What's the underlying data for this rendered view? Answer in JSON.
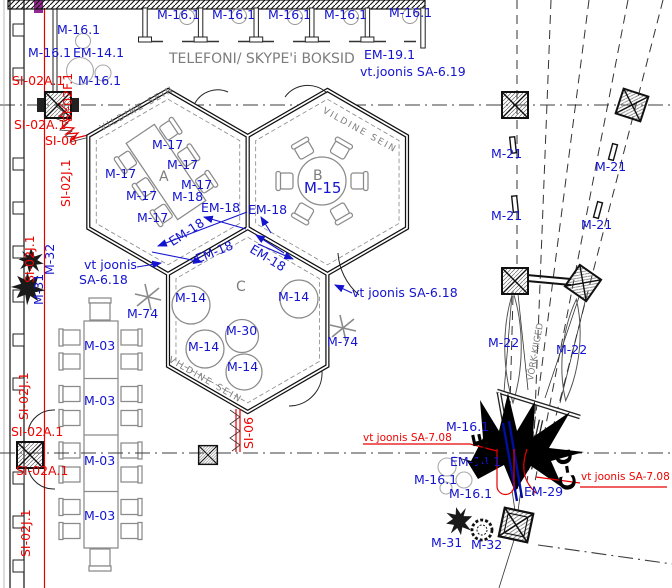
{
  "colors": {
    "label_blue": "#1414cf",
    "reference_red": "#ee0400",
    "annotation_gray": "#7d7d7d",
    "wall_black": "#111111",
    "highlight_magenta": "#92278f",
    "cable_navy": "#000f9e"
  },
  "labels": [
    {
      "t": "M-16.1",
      "x": 57,
      "y": 24
    },
    {
      "t": "M-16.1",
      "x": 28,
      "y": 47
    },
    {
      "t": "EM-14.1",
      "x": 73,
      "y": 47
    },
    {
      "t": "M-16.1",
      "x": 78,
      "y": 75
    },
    {
      "t": "M-16.1",
      "x": 157,
      "y": 9
    },
    {
      "t": "M-16.1",
      "x": 212,
      "y": 9
    },
    {
      "t": "M-16.1",
      "x": 268,
      "y": 9
    },
    {
      "t": "M-16.1",
      "x": 324,
      "y": 9
    },
    {
      "t": "M-16.1",
      "x": 389,
      "y": 7
    },
    {
      "t": "EM-19.1",
      "x": 364,
      "y": 49
    },
    {
      "t": "vt.joonis SA-6.19",
      "x": 360,
      "y": 66
    },
    {
      "t": "TELEFONI/ SKYPE'i BOKSID",
      "x": 169,
      "y": 52,
      "c": "gray",
      "s": 14
    },
    {
      "t": "SI-02F.1",
      "x": 62,
      "y": 122,
      "r": -90,
      "c": "red"
    },
    {
      "t": "SI-02A.1",
      "x": 12,
      "y": 75,
      "c": "red"
    },
    {
      "t": "SI-02A.1",
      "x": 14,
      "y": 119,
      "c": "red"
    },
    {
      "t": "SI-06",
      "x": 45,
      "y": 135,
      "c": "red"
    },
    {
      "t": "SI-02J.1",
      "x": 60,
      "y": 207,
      "r": -90,
      "c": "red"
    },
    {
      "t": "SI-02J.1",
      "x": 24,
      "y": 283,
      "r": -90,
      "c": "red"
    },
    {
      "t": "M-32",
      "x": 44,
      "y": 275,
      "r": -90
    },
    {
      "t": "M-31",
      "x": 33,
      "y": 305,
      "r": -90
    },
    {
      "t": "vt joonis",
      "x": 84,
      "y": 259
    },
    {
      "t": "SA-6.18",
      "x": 79,
      "y": 274
    },
    {
      "t": "M-74",
      "x": 127,
      "y": 308
    },
    {
      "t": "VILDINE SEIN",
      "x": 99,
      "y": 126,
      "r": -29,
      "c": "gray",
      "s": 9,
      "ls": 2
    },
    {
      "t": "VILDINE SEIN",
      "x": 325,
      "y": 107,
      "r": 29,
      "c": "gray",
      "s": 9,
      "ls": 2
    },
    {
      "t": "VILDINE SEIN",
      "x": 171,
      "y": 356,
      "r": 30,
      "c": "gray",
      "s": 9,
      "ls": 2
    },
    {
      "t": "A",
      "x": 159,
      "y": 170,
      "c": "gray",
      "s": 14
    },
    {
      "t": "B",
      "x": 313,
      "y": 169,
      "c": "gray",
      "s": 14
    },
    {
      "t": "C",
      "x": 236,
      "y": 280,
      "c": "gray",
      "s": 14
    },
    {
      "t": "M-17",
      "x": 152,
      "y": 139
    },
    {
      "t": "M-17",
      "x": 105,
      "y": 168
    },
    {
      "t": "M-17",
      "x": 167,
      "y": 159
    },
    {
      "t": "M-17",
      "x": 126,
      "y": 190
    },
    {
      "t": "M-17",
      "x": 181,
      "y": 179
    },
    {
      "t": "M-17",
      "x": 137,
      "y": 212
    },
    {
      "t": "M-18",
      "x": 172,
      "y": 191
    },
    {
      "t": "M-15",
      "x": 304,
      "y": 181,
      "s": 15
    },
    {
      "t": "EM-18",
      "x": 201,
      "y": 202
    },
    {
      "t": "EM-18",
      "x": 248,
      "y": 204
    },
    {
      "t": "EM-18",
      "x": 167,
      "y": 238,
      "r": -33
    },
    {
      "t": "EM-18",
      "x": 194,
      "y": 254,
      "r": -22
    },
    {
      "t": "EM-18",
      "x": 254,
      "y": 243,
      "r": 31
    },
    {
      "t": "M-14",
      "x": 175,
      "y": 292
    },
    {
      "t": "M-14",
      "x": 278,
      "y": 291
    },
    {
      "t": "M-14",
      "x": 188,
      "y": 341
    },
    {
      "t": "M-14",
      "x": 227,
      "y": 361
    },
    {
      "t": "M-30",
      "x": 226,
      "y": 325
    },
    {
      "t": "vt joonis SA-6.18",
      "x": 352,
      "y": 287
    },
    {
      "t": "M-74",
      "x": 327,
      "y": 336
    },
    {
      "t": "M-03",
      "x": 84,
      "y": 340
    },
    {
      "t": "M-03",
      "x": 84,
      "y": 395
    },
    {
      "t": "M-03",
      "x": 84,
      "y": 455
    },
    {
      "t": "M-03",
      "x": 84,
      "y": 510
    },
    {
      "t": "SI-02J.1",
      "x": 18,
      "y": 420,
      "r": -90,
      "c": "red"
    },
    {
      "t": "SI-02A.1",
      "x": 11,
      "y": 426,
      "c": "red"
    },
    {
      "t": "SI-02A.1",
      "x": 16,
      "y": 465,
      "c": "red"
    },
    {
      "t": "SI-02J.1",
      "x": 20,
      "y": 557,
      "r": -90,
      "c": "red"
    },
    {
      "t": "SI-06",
      "x": 243,
      "y": 449,
      "r": -90,
      "c": "red"
    },
    {
      "t": "M-21",
      "x": 491,
      "y": 148
    },
    {
      "t": "M-21",
      "x": 595,
      "y": 161
    },
    {
      "t": "M-21",
      "x": 491,
      "y": 210
    },
    {
      "t": "M-21",
      "x": 581,
      "y": 219
    },
    {
      "t": "M-22",
      "x": 488,
      "y": 337
    },
    {
      "t": "M-22",
      "x": 556,
      "y": 344
    },
    {
      "t": "VÕRK-KIIGED",
      "x": 527,
      "y": 380,
      "r": -80,
      "c": "gray",
      "s": 9
    },
    {
      "t": "M-16.1",
      "x": 446,
      "y": 421
    },
    {
      "t": "vt joonis SA-7.08",
      "x": 363,
      "y": 433,
      "c": "red",
      "s": 10.5
    },
    {
      "t": "EM-14.1",
      "x": 450,
      "y": 456
    },
    {
      "t": "M-16.1",
      "x": 414,
      "y": 474
    },
    {
      "t": "M-16.1",
      "x": 449,
      "y": 488
    },
    {
      "t": "EM-29",
      "x": 524,
      "y": 486
    },
    {
      "t": "vt joonis SA-7.08",
      "x": 581,
      "y": 472,
      "c": "red",
      "s": 10.5
    },
    {
      "t": "M-31",
      "x": 431,
      "y": 537
    },
    {
      "t": "M-32",
      "x": 471,
      "y": 539
    },
    {
      "t": "E-E",
      "x": 478,
      "y": 472,
      "r": -102,
      "c": "black",
      "s": 22,
      "w": 800
    },
    {
      "t": "C-C",
      "x": 560,
      "y": 492,
      "r": -99,
      "c": "black",
      "s": 22,
      "w": 800
    }
  ]
}
